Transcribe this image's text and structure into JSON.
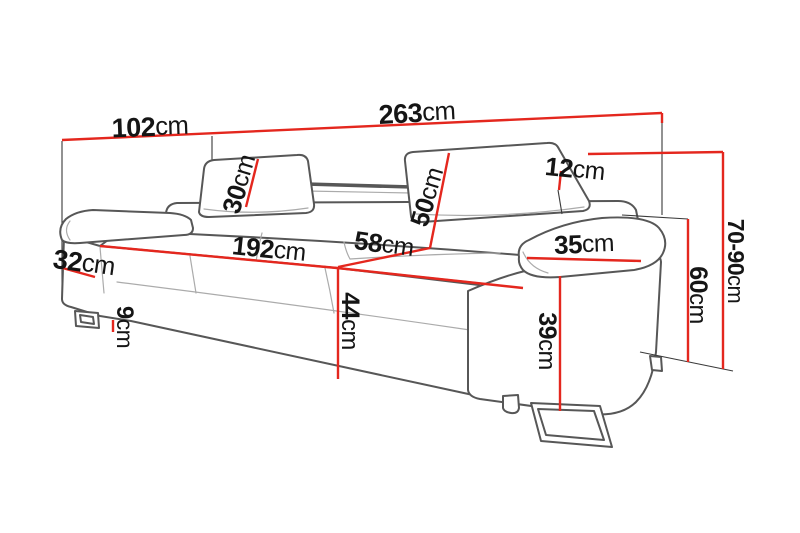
{
  "diagram": {
    "unit": "cm",
    "colors": {
      "dimension_line": "#e4271e",
      "sofa_outline": "#575757",
      "label_text": "#151515",
      "background": "#ffffff"
    },
    "dims": {
      "d102": {
        "value": "102",
        "unit": "cm"
      },
      "d263": {
        "value": "263",
        "unit": "cm"
      },
      "d12": {
        "value": "12",
        "unit": "cm"
      },
      "d30": {
        "value": "30",
        "unit": "cm"
      },
      "d50": {
        "value": "50",
        "unit": "cm"
      },
      "d70_90": {
        "value": "70-90",
        "unit": "cm"
      },
      "d60": {
        "value": "60",
        "unit": "cm"
      },
      "d35": {
        "value": "35",
        "unit": "cm"
      },
      "d32": {
        "value": "32",
        "unit": "cm"
      },
      "d192": {
        "value": "192",
        "unit": "cm"
      },
      "d58": {
        "value": "58",
        "unit": "cm"
      },
      "d44": {
        "value": "44",
        "unit": "cm"
      },
      "d39": {
        "value": "39",
        "unit": "cm"
      },
      "d9": {
        "value": "9",
        "unit": "cm"
      }
    }
  }
}
